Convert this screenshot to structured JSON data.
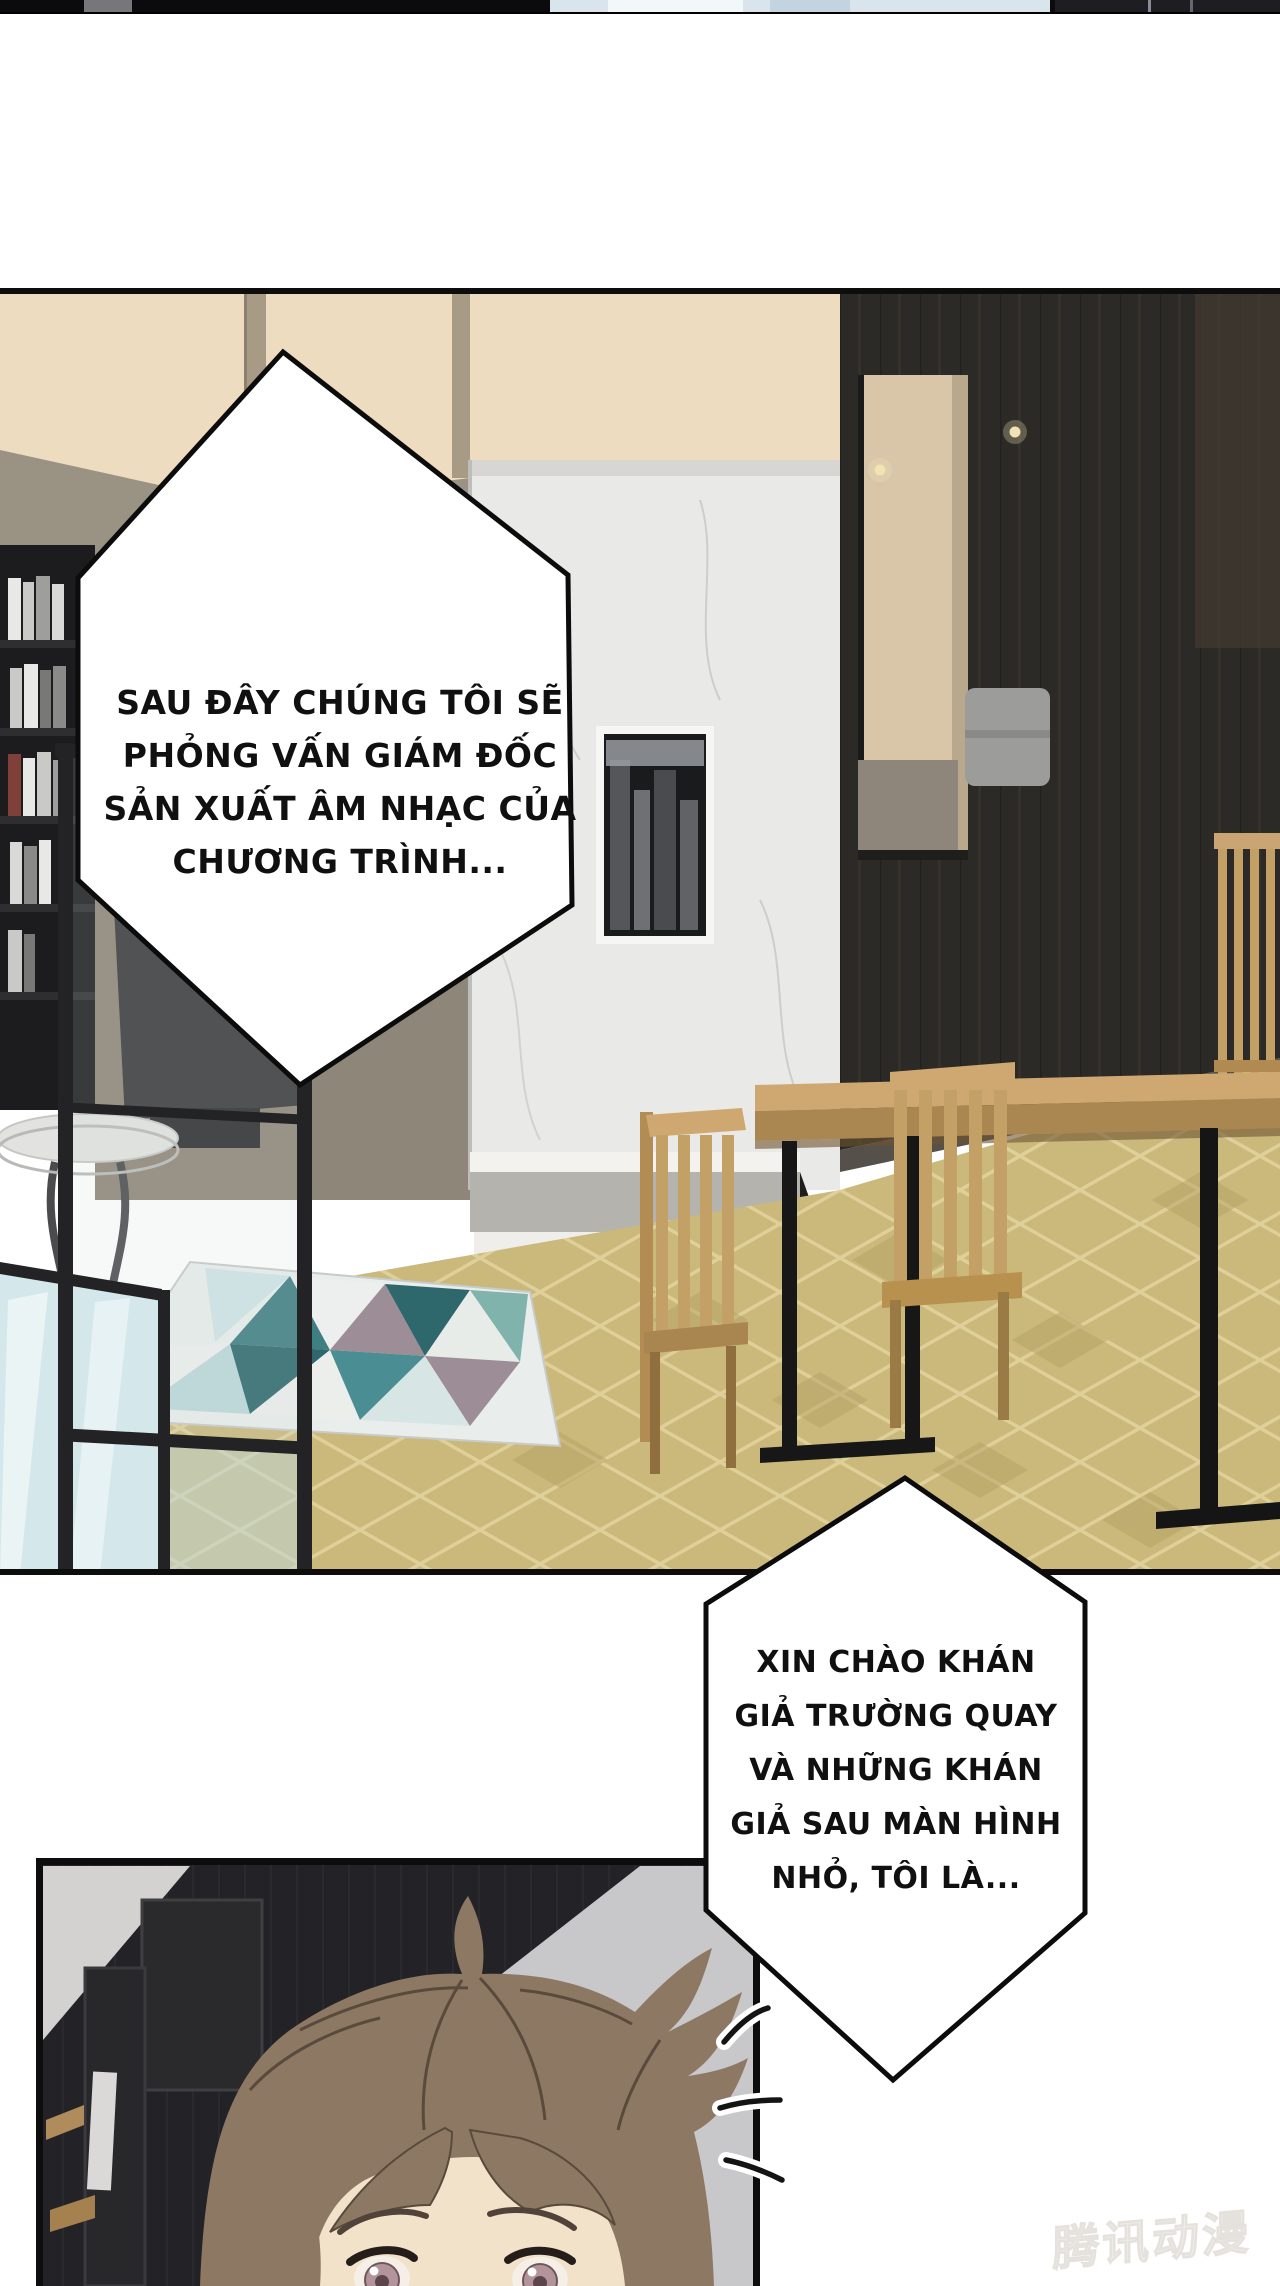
{
  "speech_bubbles": {
    "bubble1": {
      "lines": [
        "SAU ĐÂY CHÚNG TÔI SẼ",
        "PHỎNG VẤN GIÁM ĐỐC",
        "SẢN XUẤT ÂM NHẠC CỦA",
        "CHƯƠNG TRÌNH..."
      ]
    },
    "bubble2": {
      "lines": [
        "XIN CHÀO KHÁN",
        "GIẢ TRƯỜNG QUAY",
        "VÀ NHỮNG KHÁN",
        "GIẢ SAU MÀN HÌNH",
        "NHỎ, TÔI LÀ..."
      ]
    }
  },
  "watermark": {
    "text": "腾讯动漫",
    "color": "#f2f0ed"
  }
}
